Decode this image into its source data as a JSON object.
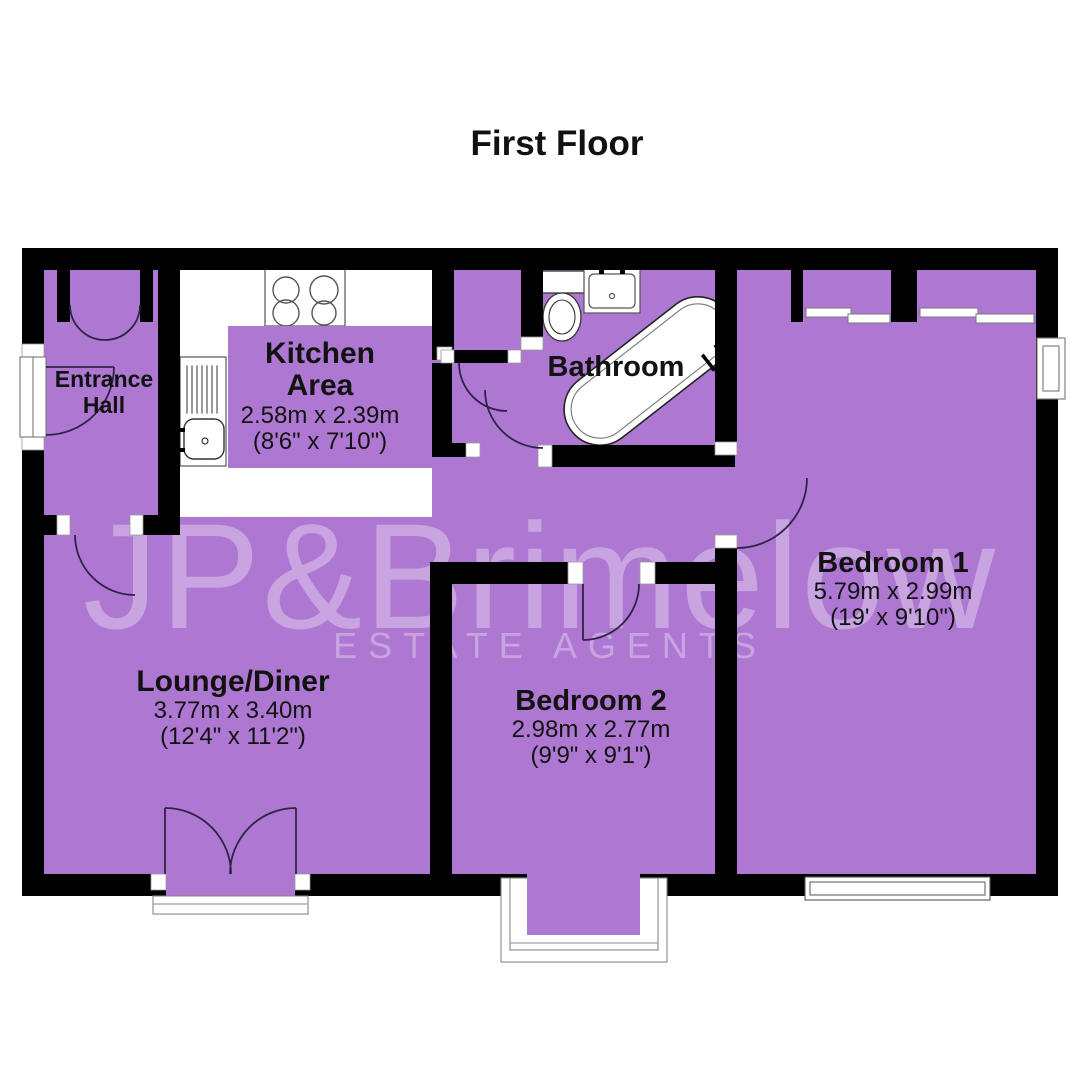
{
  "page": {
    "title": "First Floor"
  },
  "watermark": {
    "brand": "JP&Brimelow",
    "tagline": "ESTATE AGENTS"
  },
  "colors": {
    "floor_fill": "#ae78d2",
    "wall": "#000000",
    "label_text": "#121212"
  },
  "rooms": {
    "entrance_hall": {
      "name_line1": "Entrance",
      "name_line2": "Hall"
    },
    "kitchen": {
      "name_line1": "Kitchen",
      "name_line2": "Area",
      "metric": "2.58m x 2.39m",
      "imperial": "(8'6\" x 7'10\")"
    },
    "bathroom": {
      "name": "Bathroom"
    },
    "lounge": {
      "name": "Lounge/Diner",
      "metric": "3.77m x 3.40m",
      "imperial": "(12'4\" x 11'2\")"
    },
    "bedroom1": {
      "name": "Bedroom 1",
      "metric": "5.79m x 2.99m",
      "imperial": "(19' x 9'10\")"
    },
    "bedroom2": {
      "name": "Bedroom 2",
      "metric": "2.98m x 2.77m",
      "imperial": "(9'9\" x 9'1\")"
    }
  }
}
